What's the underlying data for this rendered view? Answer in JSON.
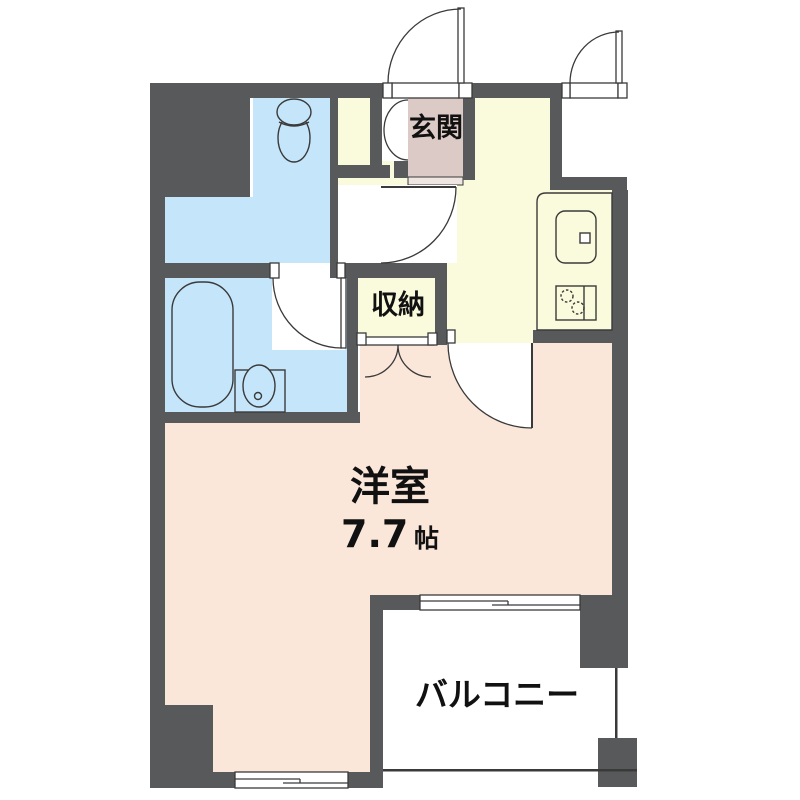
{
  "document": {
    "type": "apartment-floor-plan",
    "background": "#ffffff"
  },
  "colors": {
    "wall": "#58595b",
    "outline": "#3a3a3a",
    "water_area": "#c5e6fa",
    "kitchen_hall": "#fafadc",
    "main_room": "#fbe7da",
    "entrance_floor": "#dccac6",
    "entrance_step": "#efe6e2",
    "text": "#111111",
    "white": "#ffffff"
  },
  "labels": {
    "entrance": "玄関",
    "storage": "収納",
    "western_room": "洋室",
    "western_room_size": "7.7",
    "western_room_size_unit": "帖",
    "balcony": "バルコニー"
  },
  "fixtures": {
    "toilet": "toilet-icon",
    "bathtub": "bathtub-icon",
    "washbasin": "washbasin-icon",
    "kitchen_sink": "kitchen-sink-icon",
    "stove": "stove-burners-icon",
    "doors": [
      "front-door-swing",
      "alcove-door-swing",
      "entrance-bifold-door",
      "washroom-door-swing",
      "bathroom-door-swing",
      "kitchen-door-swing",
      "closet-double-doors"
    ],
    "windows": [
      "balcony-sliding-window",
      "bottom-sliding-window"
    ]
  }
}
